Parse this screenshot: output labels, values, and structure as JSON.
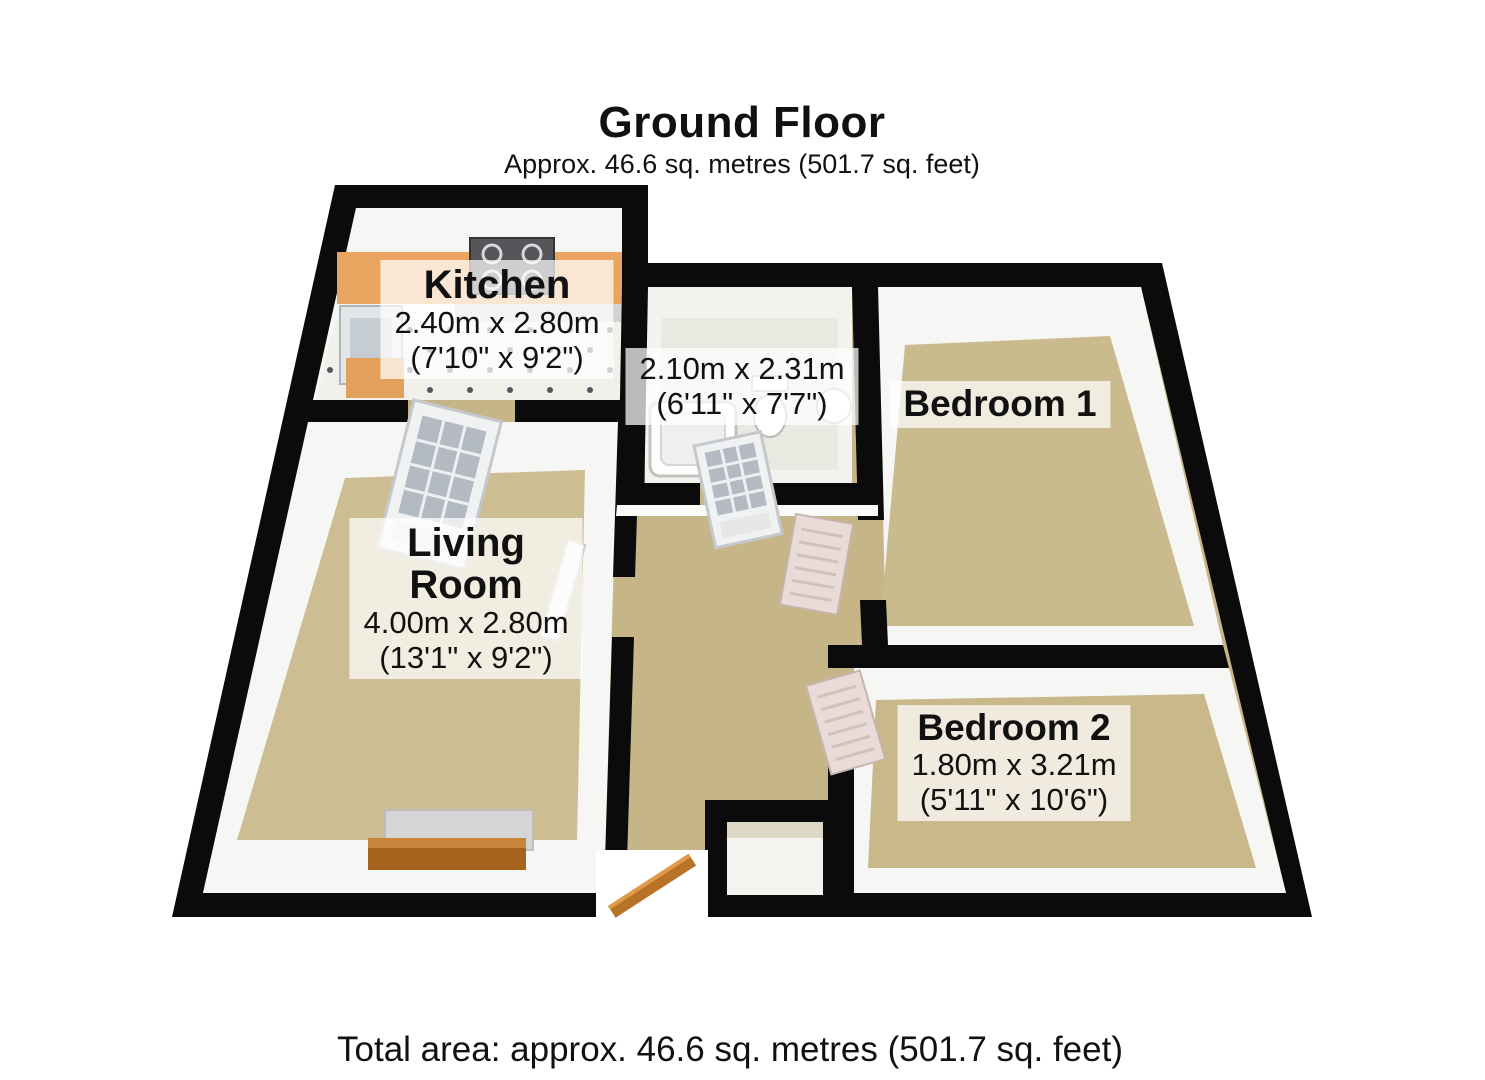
{
  "header": {
    "title": "Ground Floor",
    "subtitle": "Approx. 46.6 sq. metres (501.7 sq. feet)"
  },
  "rooms": {
    "kitchen": {
      "name": "Kitchen",
      "metric": "2.40m x 2.80m",
      "imperial": "(7'10\" x 9'2\")"
    },
    "bathroom": {
      "metric": "2.10m x 2.31m",
      "imperial": "(6'11\" x 7'7\")"
    },
    "bedroom1": {
      "name": "Bedroom 1"
    },
    "living_room": {
      "name_line1": "Living",
      "name_line2": "Room",
      "metric": "4.00m x 2.80m",
      "imperial": "(13'1\" x 9'2\")"
    },
    "bedroom2": {
      "name": "Bedroom 2",
      "metric": "1.80m x 3.21m",
      "imperial": "(5'11\" x 10'6\")"
    }
  },
  "footer": {
    "total_area": "Total area: approx. 46.6 sq. metres (501.7 sq. feet)"
  },
  "colors": {
    "wall": "#0b0b0b",
    "carpet": "#cabb8e",
    "hall_carpet": "#c6b586",
    "kitchen_counter": "#eaa660",
    "wood_door": "#b97327",
    "label_bg": "rgba(255,255,255,0.72)"
  }
}
